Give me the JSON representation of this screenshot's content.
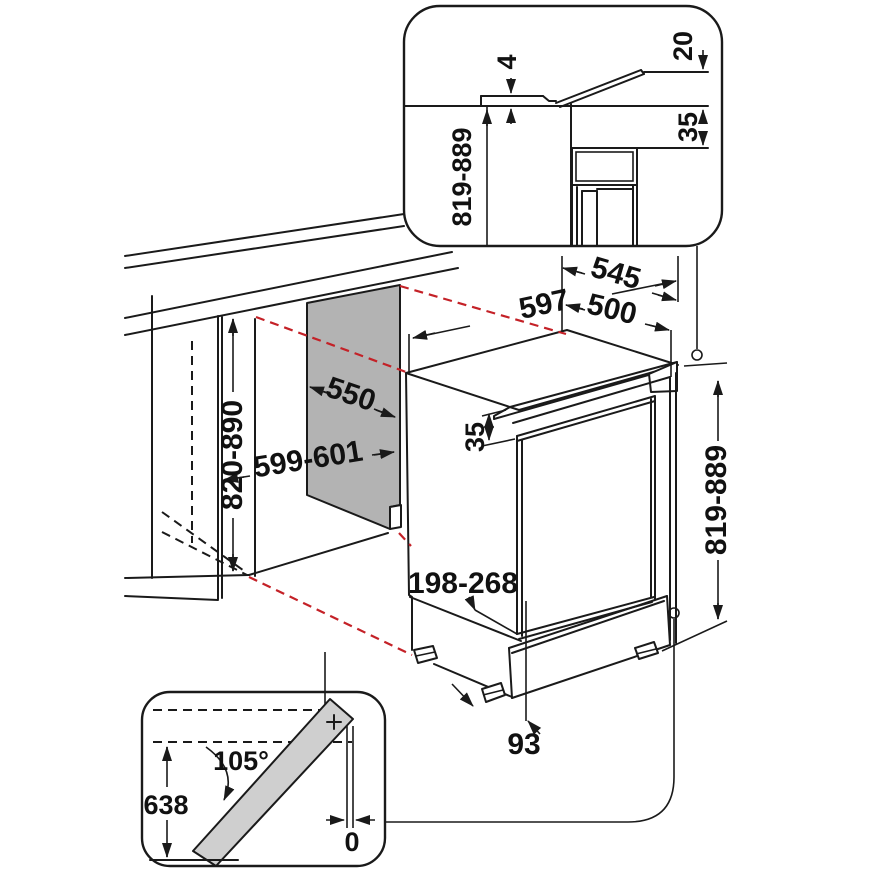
{
  "diagram": {
    "type": "built-under appliance installation drawing",
    "units": "mm"
  },
  "dimensions": {
    "top_detail": {
      "worktop_gap": "4",
      "flap_rise": "20",
      "top_recess": "35",
      "build_in_height": "819-889"
    },
    "niche": {
      "depth": "550",
      "width": "599-601",
      "height": "820-890"
    },
    "appliance": {
      "width": "597",
      "depth_total": "545",
      "depth_body": "500",
      "height": "819-889",
      "top_recess": "35",
      "plinth_height": "198-268",
      "plinth_depth": "93"
    },
    "door_swing": {
      "angle": "105°",
      "door_reach": "638",
      "side_clearance": "0"
    }
  },
  "colors": {
    "line": "#1a1a1a",
    "projection_red": "#c42127",
    "niche_panel": "#b3b3b3",
    "door_fill": "#cfcfcf",
    "background": "#ffffff"
  }
}
